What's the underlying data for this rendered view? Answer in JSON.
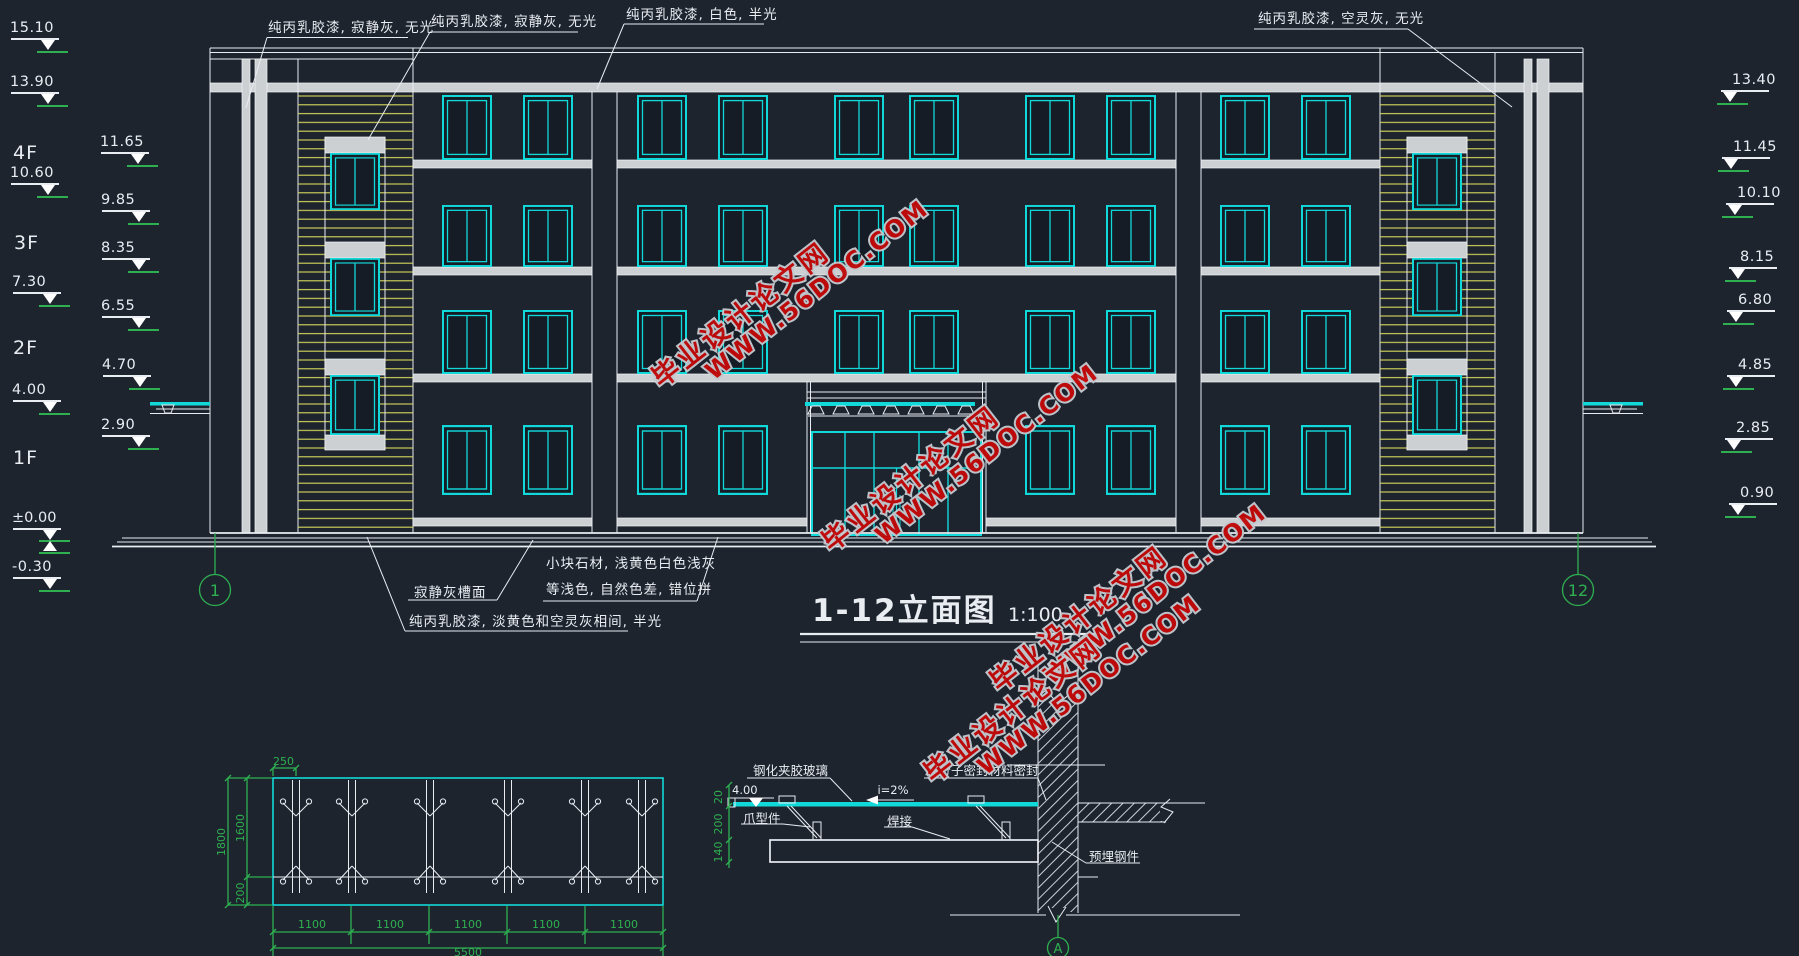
{
  "colors": {
    "bg": "#1d242e",
    "line": "#e9edf2",
    "cyan": "#12d9d9",
    "yellow": "#d8d85e",
    "green": "#2eb050",
    "gray": "#cdd0d3",
    "red": "#c20a0a"
  },
  "title": {
    "text": "1-12立面图",
    "scale": "1:100"
  },
  "top_labels": {
    "l1": "纯丙乳胶漆, 寂静灰, 无光",
    "l2": "纯丙乳胶漆, 寂静灰, 无光",
    "l3": "纯丙乳胶漆, 白色, 半光",
    "r1": "纯丙乳胶漆, 空灵灰, 无光"
  },
  "bottom_labels": {
    "groove": "寂静灰槽面",
    "stone1": "小块石材, 浅黄色白色浅灰",
    "stone2": "等浅色, 自然色差, 错位拼",
    "paint": "纯丙乳胶漆, 淡黄色和空灵灰相间, 半光"
  },
  "floors": [
    {
      "v": "4F",
      "x": 13,
      "y": 142
    },
    {
      "v": "3F",
      "x": 14,
      "y": 232
    },
    {
      "v": "2F",
      "x": 13,
      "y": 337
    },
    {
      "v": "1F",
      "x": 13,
      "y": 447
    }
  ],
  "markers": {
    "zero": "±0.00",
    "left_outer": [
      {
        "v": "15.10",
        "x": 11,
        "y": 38
      },
      {
        "v": "13.90",
        "x": 11,
        "y": 92
      },
      {
        "v": "10.60",
        "x": 11,
        "y": 183
      },
      {
        "v": "7.30",
        "x": 13,
        "y": 292
      },
      {
        "v": "4.00",
        "x": 13,
        "y": 400
      },
      {
        "v": "-0.30",
        "x": 13,
        "y": 577
      }
    ],
    "left_inner": [
      {
        "v": "11.65",
        "x": 101,
        "y": 152
      },
      {
        "v": "9.85",
        "x": 102,
        "y": 210
      },
      {
        "v": "8.35",
        "x": 102,
        "y": 258
      },
      {
        "v": "6.55",
        "x": 102,
        "y": 316
      },
      {
        "v": "4.70",
        "x": 103,
        "y": 375
      },
      {
        "v": "2.90",
        "x": 102,
        "y": 435
      }
    ],
    "right": [
      {
        "v": "13.40",
        "x": 1721,
        "y": 90
      },
      {
        "v": "11.45",
        "x": 1722,
        "y": 157
      },
      {
        "v": "10.10",
        "x": 1726,
        "y": 203
      },
      {
        "v": "8.15",
        "x": 1729,
        "y": 267
      },
      {
        "v": "6.80",
        "x": 1727,
        "y": 310
      },
      {
        "v": "4.85",
        "x": 1727,
        "y": 375
      },
      {
        "v": "2.85",
        "x": 1725,
        "y": 438
      },
      {
        "v": "0.90",
        "x": 1729,
        "y": 503
      }
    ]
  },
  "axis_bubbles": {
    "left": "1",
    "right": "12",
    "section": "A"
  },
  "watermark": {
    "line1": "毕业设计论文网",
    "line2": "WWW.56DOC.COM",
    "instances": [
      {
        "x": 630,
        "y": 266
      },
      {
        "x": 800,
        "y": 430
      },
      {
        "x": 968,
        "y": 570
      },
      {
        "x": 902,
        "y": 661
      }
    ]
  },
  "plan": {
    "d250": "250",
    "d1800": "1800",
    "d1600": "1600",
    "d200": "200",
    "seg": "1100",
    "total": "5500"
  },
  "section": {
    "glass": "钢化夹胶玻璃",
    "seal": "高分子密封材料密封",
    "claw": "爪型件",
    "weld": "焊接",
    "embed": "预埋钢件",
    "slope": "i=2%",
    "level": "4.00",
    "d20": "20",
    "d200": "200",
    "d140": "140"
  }
}
